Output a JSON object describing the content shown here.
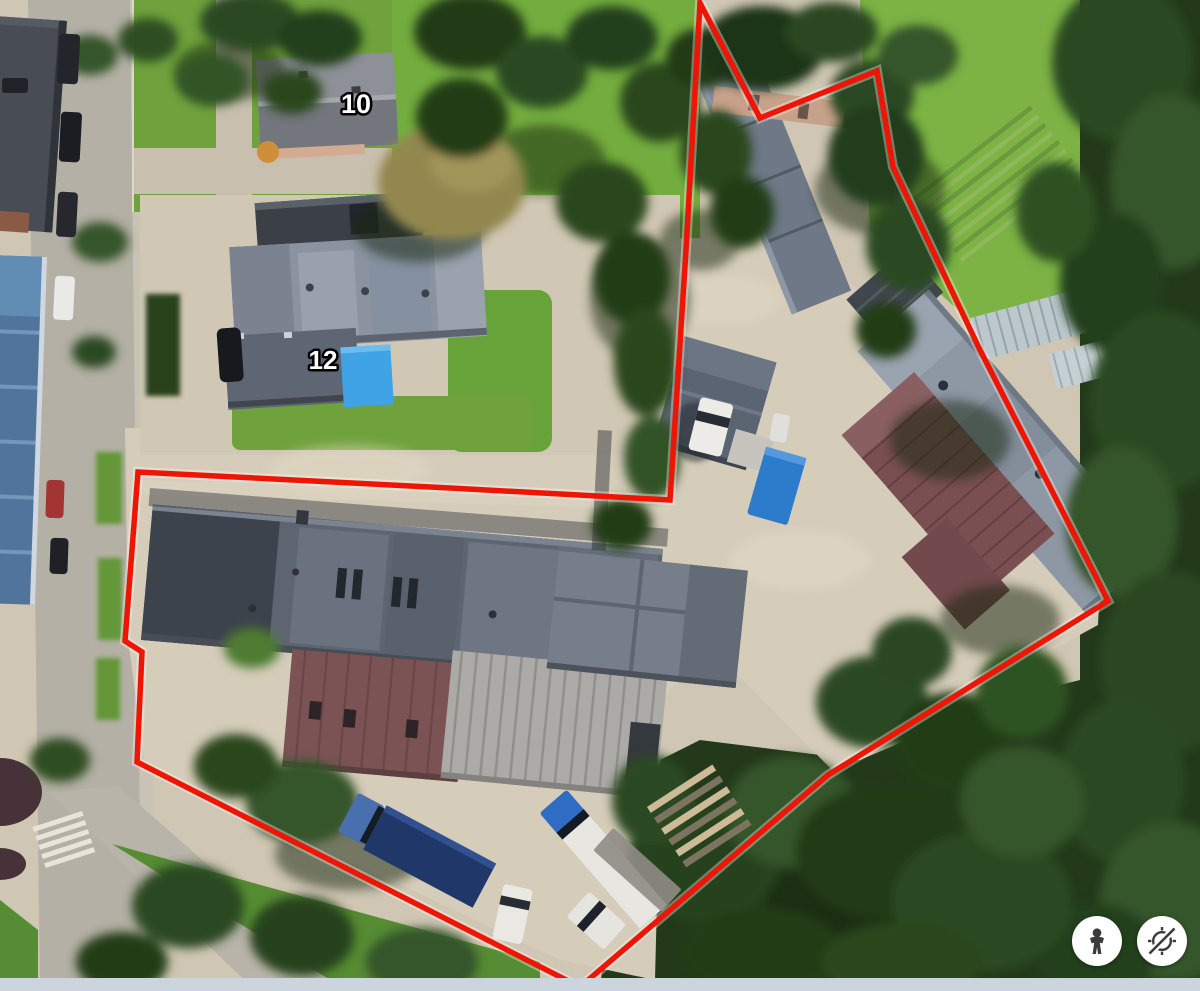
{
  "view": {
    "type": "satellite-aerial-map",
    "bottom_strip_color": "#ccd5dd"
  },
  "labels": {
    "house10": "10",
    "house12": "12"
  },
  "parcel": {
    "outline_color": "#ee1505",
    "points": "700,3 760,118 877,71 893,167 980,350 1095,575 1108,601 828,775 580,987 137,762 142,652 125,641 138,472 450,488 670,500 686,250"
  },
  "controls": {
    "pegman": {
      "icon": "pegman-icon"
    },
    "compass_disabled": {
      "icon": "compass-disabled-icon"
    }
  }
}
